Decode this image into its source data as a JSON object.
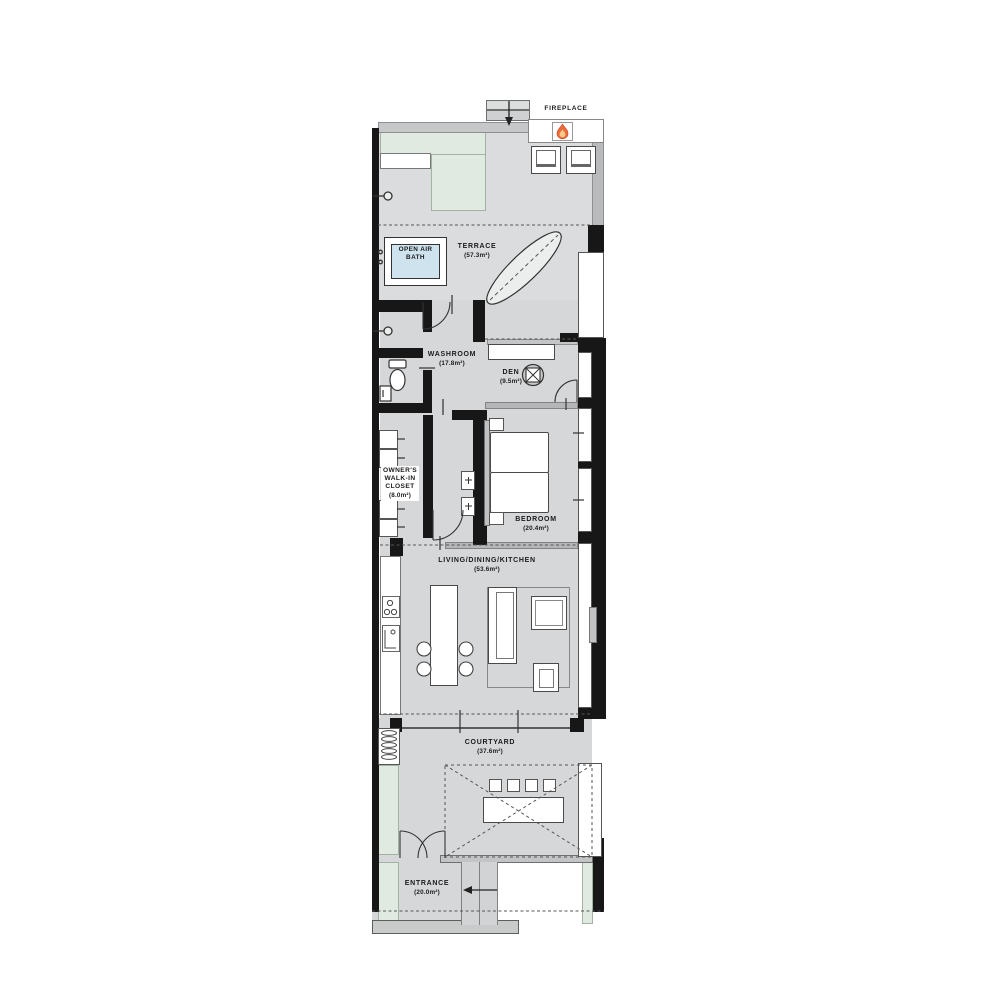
{
  "plan": {
    "type": "floor-plan",
    "labels": {
      "fireplace": "FIREPLACE",
      "open_air_bath": {
        "line1": "OPEN AIR",
        "line2": "BATH"
      }
    },
    "rooms": {
      "terrace": {
        "name": "TERRACE",
        "area": "(57.3m²)"
      },
      "washroom": {
        "name": "WASHROOM",
        "area": "(17.8m²)"
      },
      "den": {
        "name": "DEN",
        "area": "(9.5m²)"
      },
      "closet": {
        "line1": "OWNER'S",
        "line2": "WALK-IN",
        "line3": "CLOSET",
        "area": "(8.0m²)"
      },
      "bedroom": {
        "name": "BEDROOM",
        "area": "(20.4m²)"
      },
      "ldk": {
        "name": "LIVING/DINING/KITCHEN",
        "area": "(53.6m²)"
      },
      "courtyard": {
        "name": "COURTYARD",
        "area": "(37.6m²)"
      },
      "entrance": {
        "name": "ENTRANCE",
        "area": "(20.0m²)"
      }
    },
    "icons": {
      "fire": "flame-icon",
      "faucet": "faucet-icon",
      "toilet": "toilet-icon",
      "stove": "stove-icon",
      "sink": "sink-icon",
      "chair": "office-chair-icon",
      "entry_arrow": "entry-direction-arrow",
      "chimney_arrow": "chimney-arrow"
    },
    "colors": {
      "wall": "#171717",
      "floor": "#d6d7d8",
      "terrace_floor": "#dbdcdd",
      "green": "#e0eae1",
      "bath_blue": "#cfe3ee",
      "flame_outer": "#ed6a3a",
      "flame_inner": "#f8c98e",
      "track_gray": "#b5b6b7",
      "step_gray": "#c9caca"
    }
  }
}
